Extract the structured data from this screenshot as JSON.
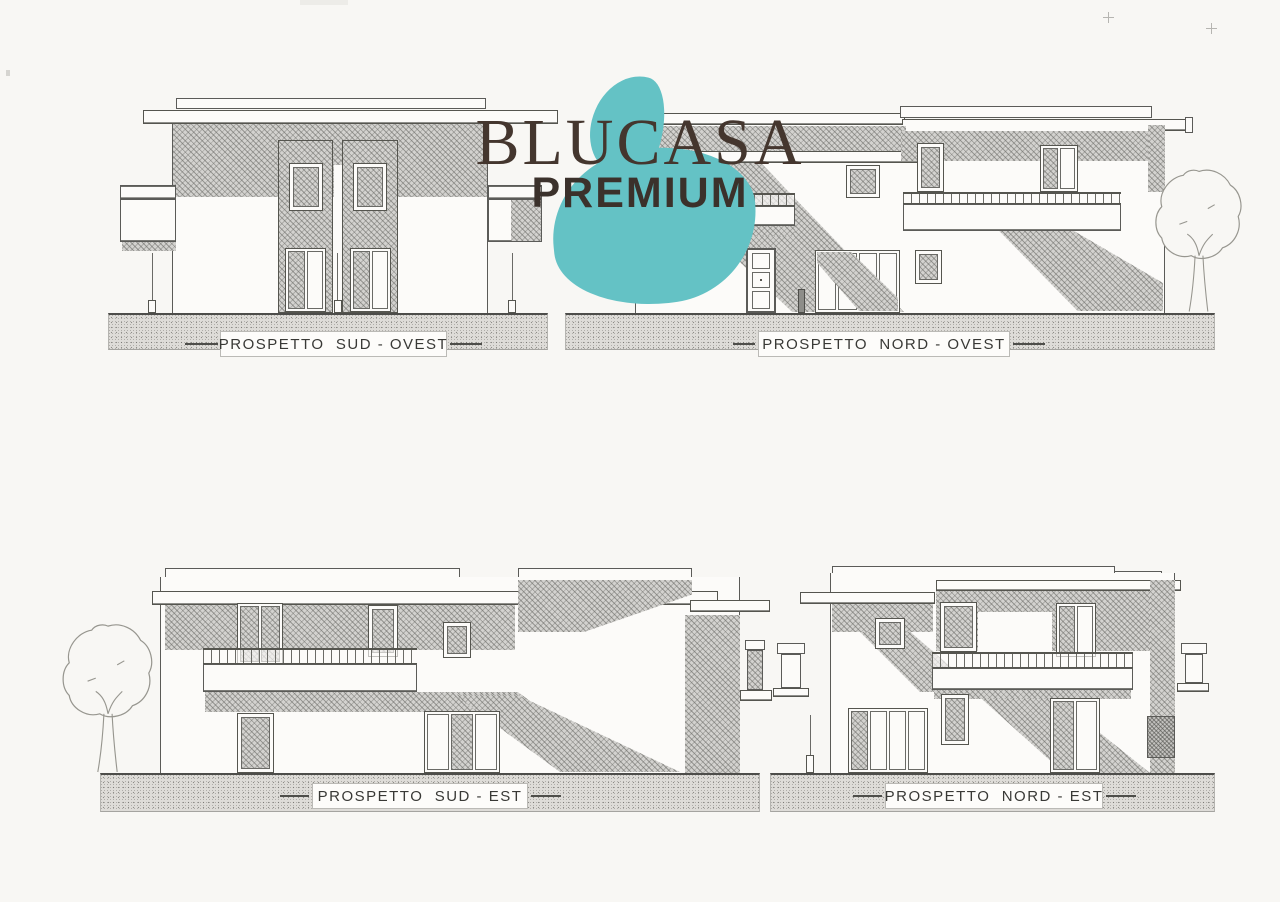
{
  "logo": {
    "name": "BLUCASA",
    "tier": "PREMIUM",
    "accent_color": "#64c2c5",
    "text_color": "#44362e"
  },
  "elevations": [
    {
      "id": "sud-ovest",
      "label": "PROSPETTO  SUD - OVEST"
    },
    {
      "id": "nord-ovest",
      "label": "PROSPETTO  NORD - OVEST"
    },
    {
      "id": "sud-est",
      "label": "PROSPETTO  SUD - EST"
    },
    {
      "id": "nord-est",
      "label": "PROSPETTO  NORD - EST"
    }
  ],
  "palette": {
    "paper": "#f8f7f4",
    "line": "#5b5b58",
    "shadow_hatch": "#c9c8c5",
    "ground_fill": "#dedcd8",
    "label_text": "#393936"
  }
}
